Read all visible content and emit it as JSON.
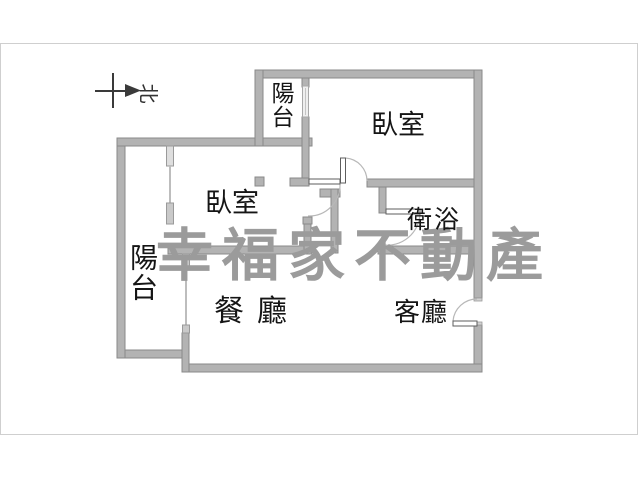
{
  "compass": {
    "north_label": "北"
  },
  "watermark": {
    "text": "幸福家不動產"
  },
  "rooms": [
    {
      "id": "balcony-top",
      "label": "陽台"
    },
    {
      "id": "bedroom-right",
      "label": "臥室"
    },
    {
      "id": "bedroom-left",
      "label": "臥室"
    },
    {
      "id": "balcony-left",
      "label": "陽台"
    },
    {
      "id": "bathroom",
      "label": "衛浴"
    },
    {
      "id": "dining",
      "label": "餐廳"
    },
    {
      "id": "living",
      "label": "客廳"
    }
  ],
  "colors": {
    "wall": "#b3b3b3",
    "wall_outline": "#8a8a8a",
    "watermark": "#9b9b9b",
    "label": "#151515",
    "frame": "#cfcfcf"
  }
}
